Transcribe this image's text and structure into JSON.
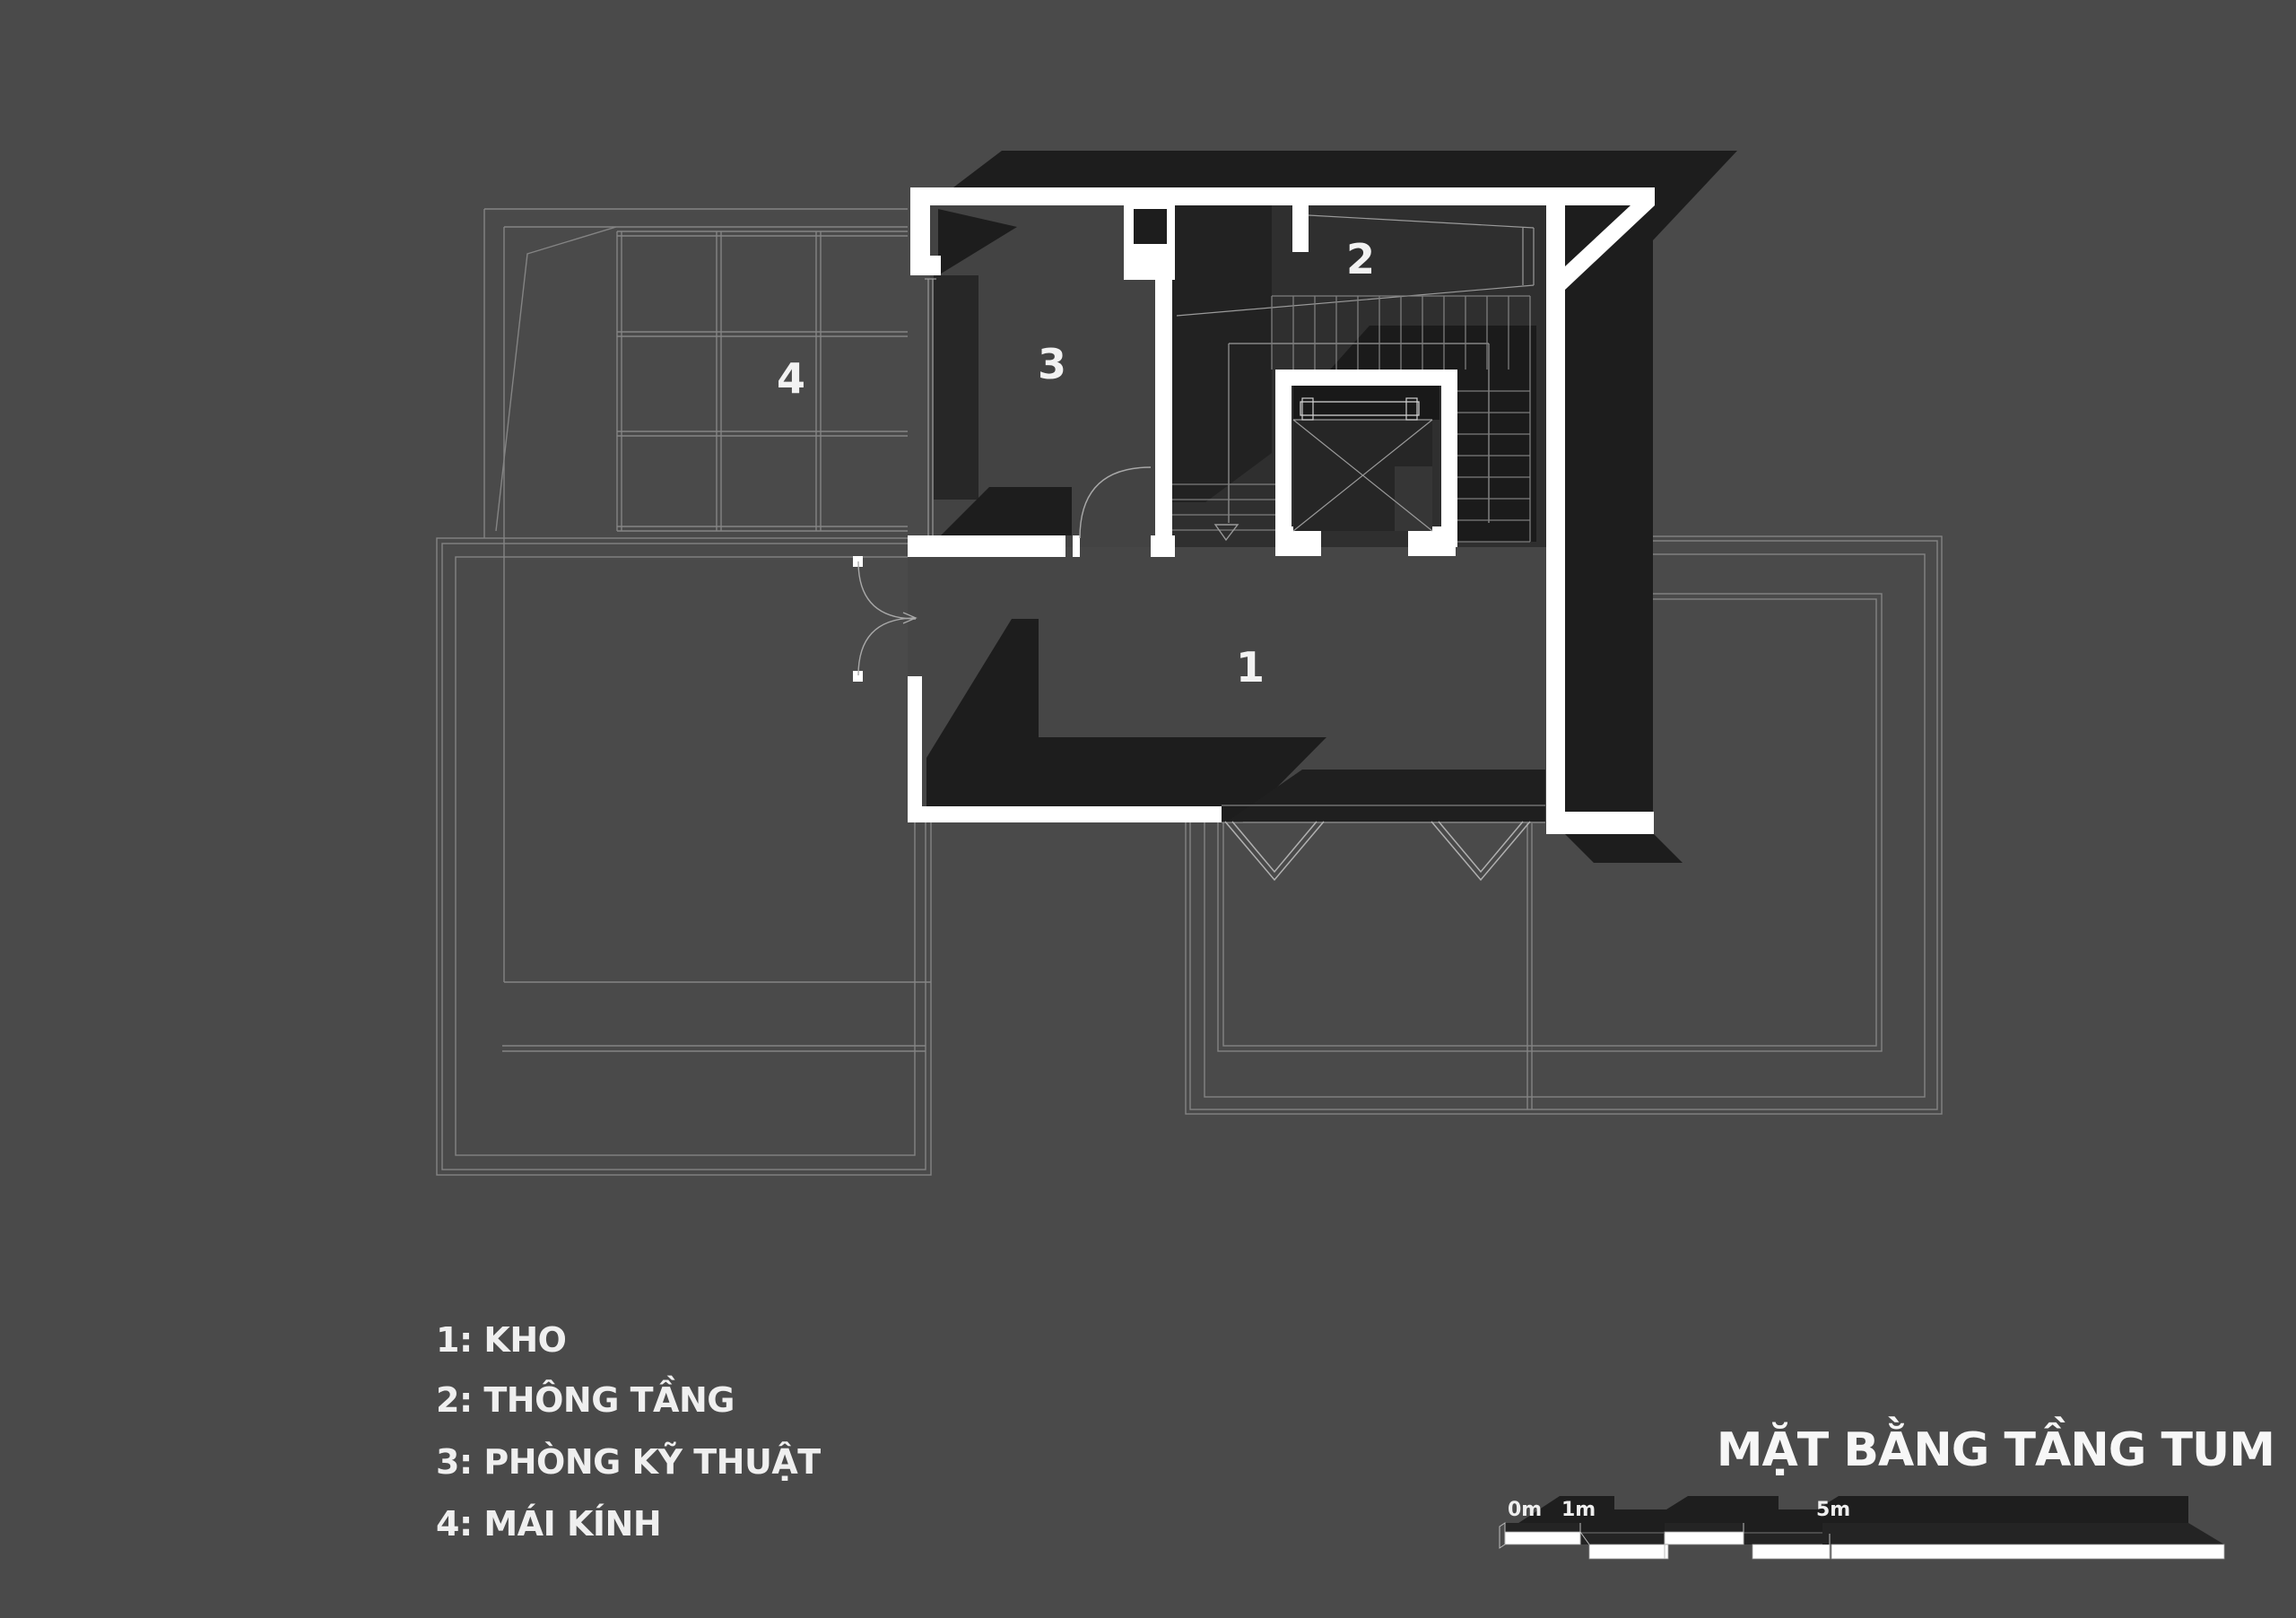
{
  "title": {
    "text": "MẶT BẰNG TẦNG TUM"
  },
  "legend": {
    "items": [
      {
        "text": "1: KHO"
      },
      {
        "text": "2: THÔNG TẦNG"
      },
      {
        "text": "3: PHÒNG KỸ THUẬT"
      },
      {
        "text": "4: MÁI KÍNH"
      }
    ]
  },
  "room_labels": {
    "storage": "1",
    "void": "2",
    "technical": "3",
    "glass_roof": "4"
  },
  "scale_bar": {
    "label_0m": "0m",
    "label_1m": "1m",
    "label_5m": "5m"
  },
  "colors": {
    "background": "#4a4a4a",
    "wall": "#ffffff",
    "shadow": "#1d1d1d",
    "void_fill": "#2f2f2f",
    "room_fill": "#464646",
    "outline": "#848484",
    "text": "#f2f2f2"
  }
}
